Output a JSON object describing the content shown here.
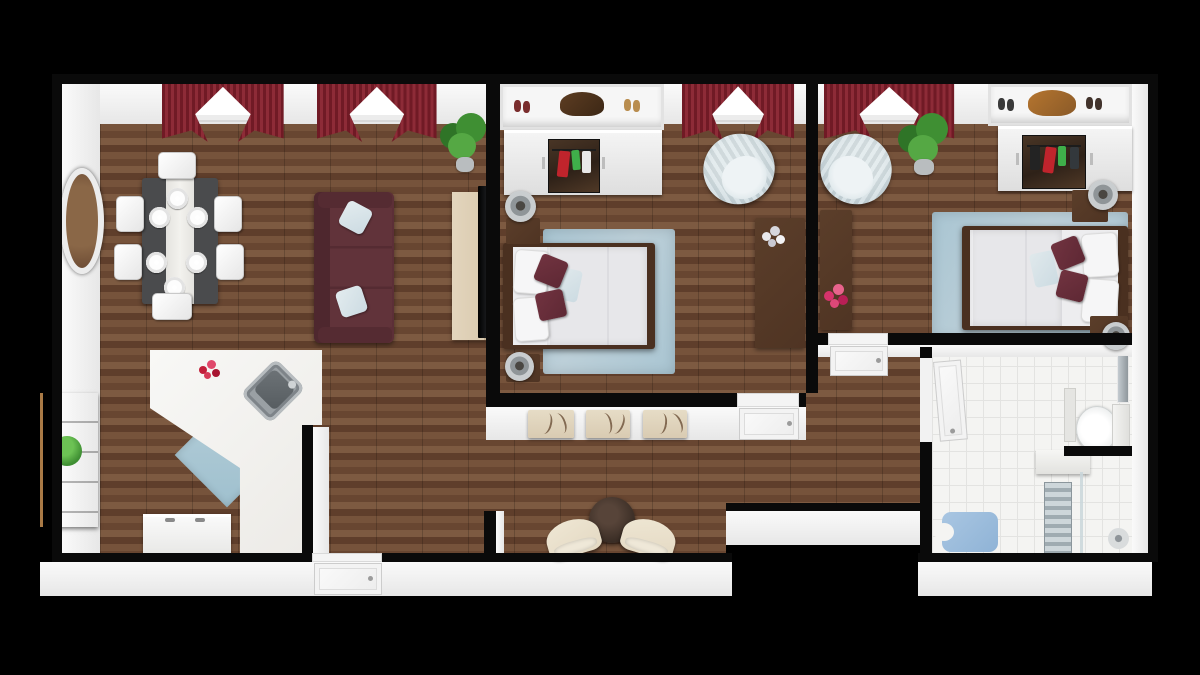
{
  "scene": {
    "title": "3D floor plan — two-bedroom apartment, top-down view",
    "style": "photoreal 3D dollhouse render on black background",
    "rooms": [
      {
        "name": "living-dining-kitchen",
        "floor": "dark wood planks",
        "furniture": [
          "round wall mirror",
          "dining table with white runner and six place settings",
          "six white dining chairs",
          "burgundy three-seat sofa with two light-blue throw pillows",
          "tan media console with flat TV",
          "corner potted plant",
          "L-shaped white kitchen counter with stainless sink",
          "red flowers on counter",
          "light-blue kitchen mat",
          "white under-counter appliance",
          "wooden sideboard with plant",
          "two windows with dark-red curtains",
          "front door"
        ]
      },
      {
        "name": "bedroom-1",
        "floor": "dark wood planks",
        "furniture": [
          "open shelf with shoes and handbag",
          "mirrored sliding wardrobe with hanging clothes",
          "window with dark-red curtains",
          "light-blue tub armchair",
          "double bed with white duvet, two burgundy pillows and one light-blue pillow",
          "light-blue area rug",
          "two nightstands with drum lamps",
          "tall dark dresser with white flowers",
          "white interior door"
        ]
      },
      {
        "name": "bedroom-2",
        "floor": "dark wood planks",
        "furniture": [
          "open shelf with shoes and handbag",
          "mirrored sliding wardrobe with hanging clothes",
          "window with dark-red curtains",
          "light-blue tub armchair",
          "potted plant",
          "dark wood desk with pink flowers",
          "double bed with white duvet, two burgundy pillows and one light-blue pillow",
          "light-blue area rug",
          "two nightstands with drum lamps",
          "white interior door"
        ]
      },
      {
        "name": "hallway",
        "floor": "dark wood planks",
        "furniture": [
          "three abstract canvases on wall",
          "round dark side table",
          "two cream slipper chairs"
        ]
      },
      {
        "name": "bathroom",
        "floor": "white square tile",
        "furniture": [
          "white interior door",
          "toilet with tank in alcove",
          "wall mirror panel",
          "slim storage shelf",
          "white ledge",
          "towel radiator",
          "glass shower screen",
          "shower head on riser",
          "light-blue U-shaped bath mat"
        ]
      }
    ],
    "palette_note": "colors used by the render are listed in palette"
  },
  "palette": {
    "cap": "#0a0a0a",
    "wood_a": "#76533b",
    "wood_b": "#684631",
    "wood_c": "#7d5a41",
    "wood_d": "#5f3e2b",
    "tile": "#f4f4f2",
    "tile_line": "#e3e3e1",
    "curtain_a": "#701a25",
    "curtain_b": "#8d2b37",
    "sofa": "#5c2f37",
    "sofa_dark": "#4e272e",
    "pillow_blue": "#ccdbe2",
    "pillow_white": "#f6f6f7",
    "accent": "#5e2834",
    "rug": "#a9c5d2",
    "bedframe": "#4a3020",
    "duvet": "#e7e7ea",
    "chair_blue": "#c9d7dc",
    "charcoal": "#4a4b4d",
    "cream": "#e3d8c2",
    "canvas": "#d9cbb2",
    "canvas_line": "#6b4f37",
    "wood_furn": "#4f3423",
    "wood_side": "#8a5a33",
    "console": "#d9c9ae",
    "plant": "#3f8f33",
    "plant_dark": "#2f7427",
    "kmat": "#9fc0ce",
    "bathmat": "#8fb3d6",
    "steel": "#9aa0a4",
    "lamp": "#c9cdcf",
    "lamp_core": "#4a4742",
    "radiator_a": "#cdd6da",
    "radiator_b": "#9fabb1"
  }
}
